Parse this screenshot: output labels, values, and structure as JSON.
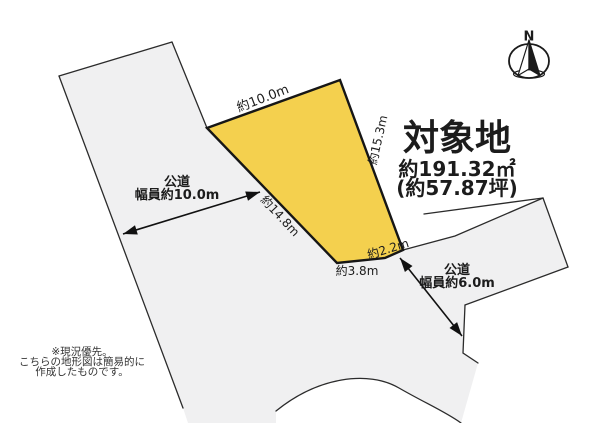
{
  "target": {
    "title": "対象地",
    "area_sqm": "約191.32㎡",
    "area_tsubo": "(約57.87坪)"
  },
  "compass": {
    "north_label": "N"
  },
  "dimensions": {
    "top_edge": "約10.0m",
    "right_edge": "約15.3m",
    "left_edge": "約14.8m",
    "bottom_edge": "約3.8m",
    "corner_edge": "約2.2m"
  },
  "roads": {
    "west": {
      "name": "公道",
      "width": "幅員約10.0m"
    },
    "southeast": {
      "name": "公道",
      "width": "幅員約6.0m"
    }
  },
  "note": {
    "line1": "※現況優先。",
    "line2": "こちらの地形図は簡易的に",
    "line3": "作成したものです。"
  },
  "colors": {
    "plot_fill": "#f4d04e",
    "plot_stroke": "#161616",
    "road_fill": "#f0f0f1",
    "line": "#2b2b2b",
    "arrow": "#111111",
    "white": "#ffffff"
  }
}
